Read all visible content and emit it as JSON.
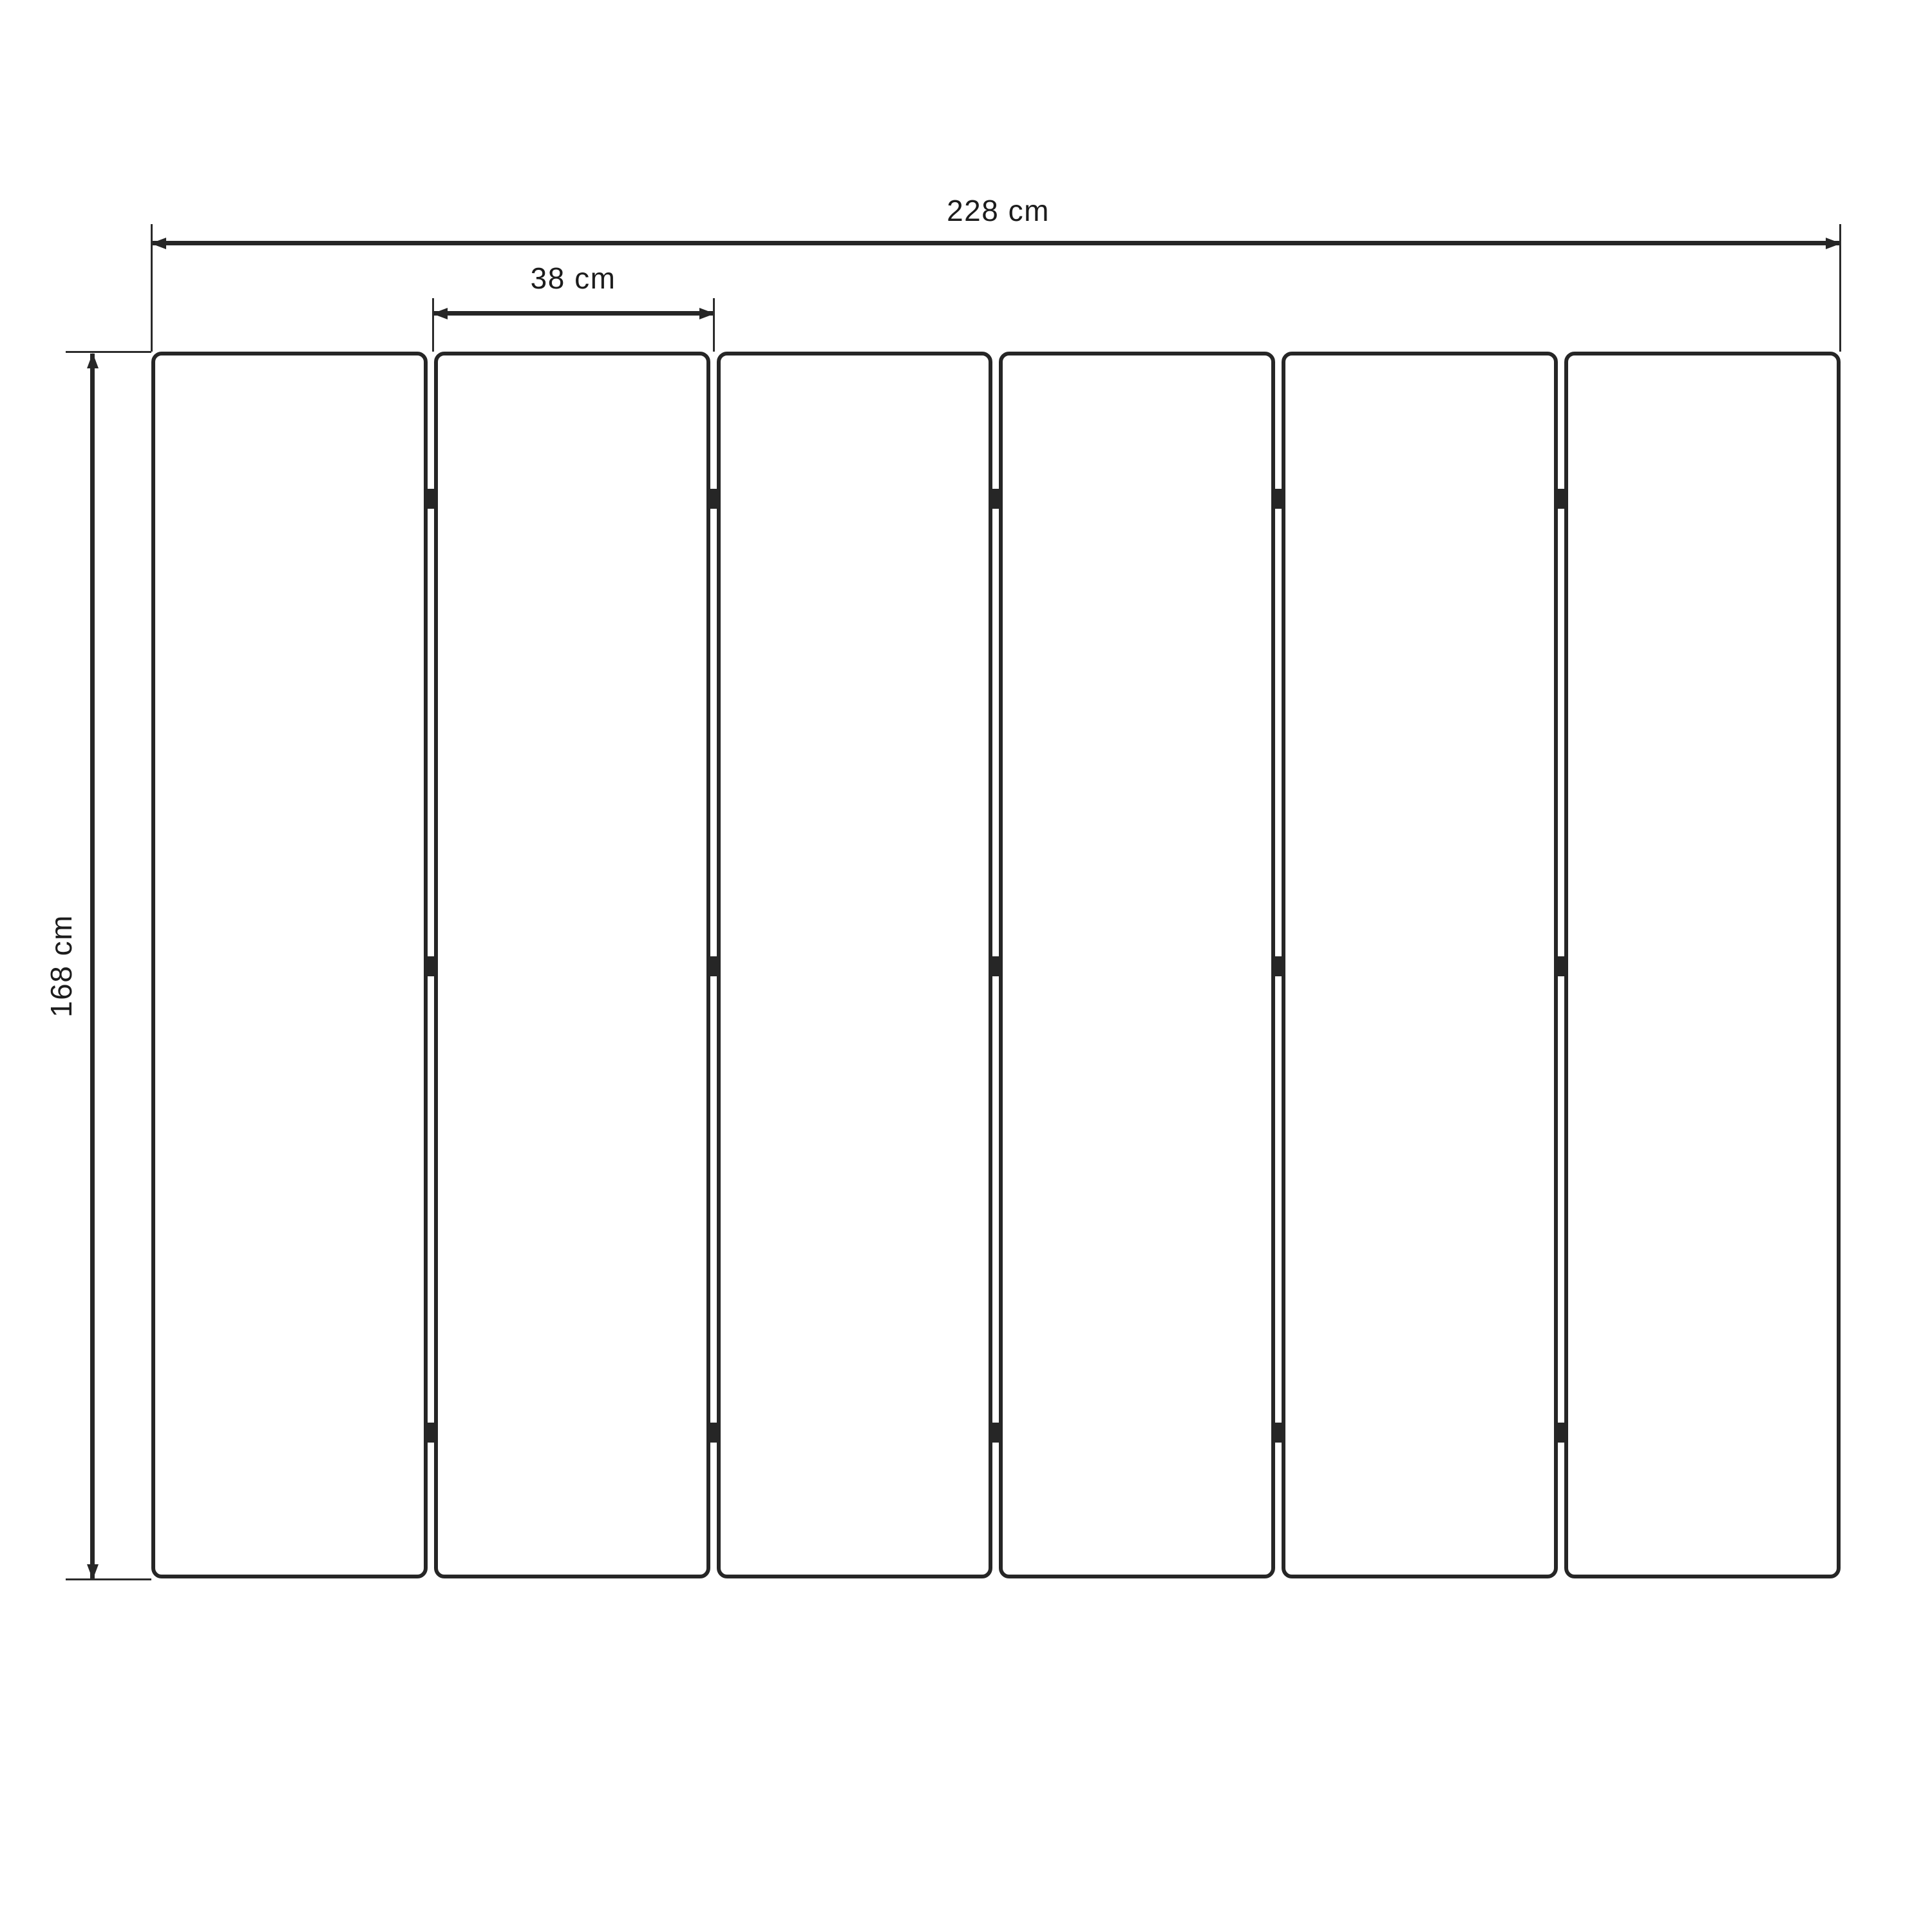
{
  "diagram": {
    "type": "dimension-drawing",
    "labels": {
      "total_width": "228 cm",
      "panel_width": "38 cm",
      "height": "168 cm"
    },
    "panels": {
      "count": 6,
      "hinge_columns": 5,
      "hinges_per_column": 3
    },
    "colors": {
      "line": "#262626",
      "text": "#1c1c1c",
      "background": "#ffffff"
    }
  }
}
